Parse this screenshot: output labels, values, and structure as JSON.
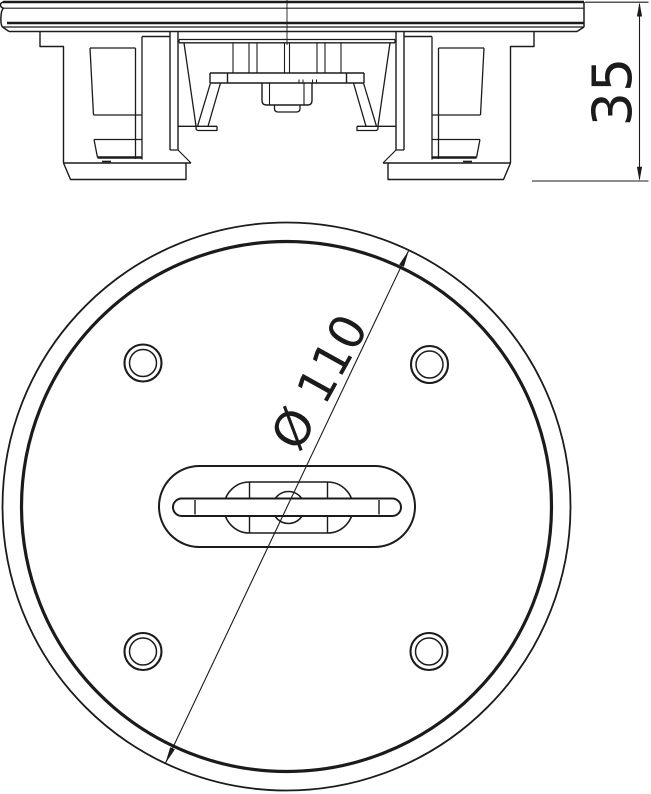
{
  "drawing": {
    "side_view": {
      "height_dimension": "35"
    },
    "top_view": {
      "diameter_dimension": "Ø 110"
    },
    "colors": {
      "line": "#1b1b1b",
      "background": "#ffffff"
    }
  }
}
